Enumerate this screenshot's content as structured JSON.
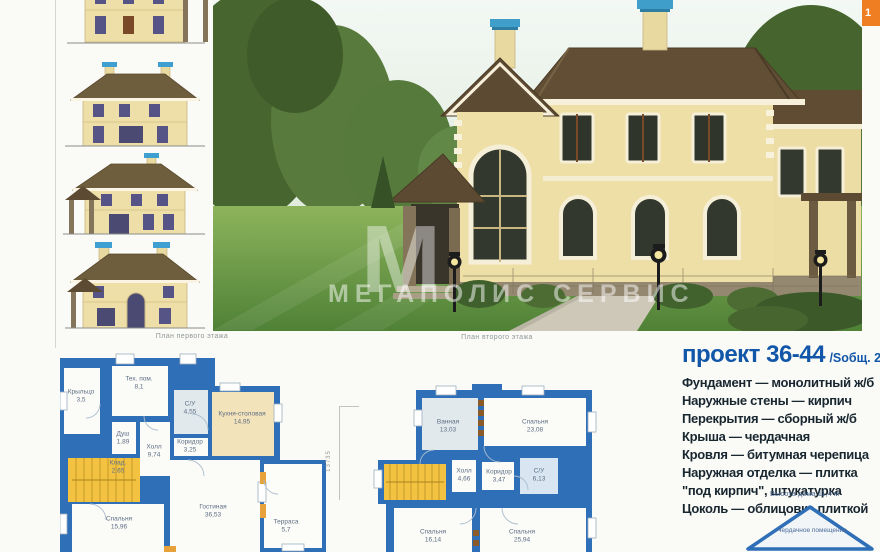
{
  "page": {
    "tab_number": "1",
    "watermark": {
      "letter": "М",
      "text": "МЕГАПОЛИС СЕРВИС"
    }
  },
  "captions": {
    "plan1": "План первого этажа",
    "plan2": "План второго этажа"
  },
  "project": {
    "title": "проект 36-44",
    "area_label": "/Sобщ. 212,05 м²",
    "specs": [
      "Фундамент — монолитный ж/б",
      "Наружные стены — кирпич",
      "Перекрытия — сборный ж/б",
      "Крыша — чердачная",
      "Кровля — битумная черепица",
      "Наружная отделка — плитка \"под кирпич\", штукатурка",
      "Цоколь — облицовка плиткой"
    ],
    "height_note": "Высота дома 11,4 м",
    "attic_label": "Чердачное помещение"
  },
  "plan1": {
    "dimension": "13735",
    "rooms": [
      {
        "name": "Крыльцо",
        "area": "3,5"
      },
      {
        "name": "Тех. пом.",
        "area": "8,1"
      },
      {
        "name": "С/У",
        "area": "4,55"
      },
      {
        "name": "Кухня-столовая",
        "area": "14,95"
      },
      {
        "name": "Душ",
        "area": "1,89"
      },
      {
        "name": "Коридор",
        "area": "3,25"
      },
      {
        "name": "Холл",
        "area": "9,74"
      },
      {
        "name": "Клад.",
        "area": "2,65"
      },
      {
        "name": "Спальня",
        "area": "15,96"
      },
      {
        "name": "Гостиная",
        "area": "36,53"
      },
      {
        "name": "Терраса",
        "area": "5,7"
      }
    ]
  },
  "plan2": {
    "rooms": [
      {
        "name": "Ванная",
        "area": "13,03"
      },
      {
        "name": "Спальня",
        "area": "23,08"
      },
      {
        "name": "Холл",
        "area": "4,66"
      },
      {
        "name": "Коридор",
        "area": "3,47"
      },
      {
        "name": "С/У",
        "area": "6,13"
      },
      {
        "name": "Спальня",
        "area": "16,14"
      },
      {
        "name": "Спальня",
        "area": "25,94"
      }
    ]
  },
  "colors": {
    "plan_wall_blue": "#2e6fb7",
    "stairs_yellow": "#f2c240",
    "kitchen_cream": "#f3e3ba",
    "title_blue": "#1156a8",
    "tab_orange": "#ef7d22"
  }
}
